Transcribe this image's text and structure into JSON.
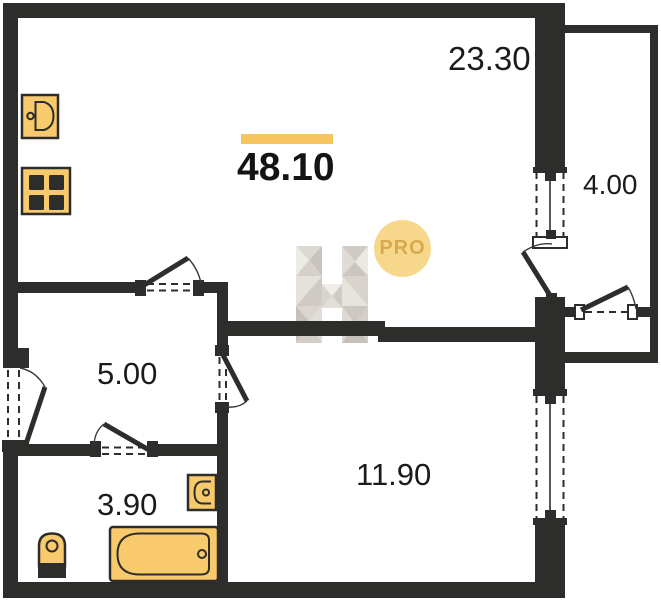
{
  "plan": {
    "total_area": "48.10",
    "badge_label": "PRO",
    "rooms": [
      {
        "name": "living-kitchen",
        "area": "23.30"
      },
      {
        "name": "loggia",
        "area": "4.00"
      },
      {
        "name": "hallway",
        "area": "5.00"
      },
      {
        "name": "bathroom",
        "area": "3.90"
      },
      {
        "name": "bedroom",
        "area": "11.90"
      }
    ],
    "fixtures": [
      "kitchen-sink",
      "stove",
      "washbasin",
      "toilet",
      "bathtub"
    ],
    "colors": {
      "wall": "#2D2D2B",
      "fixture_fill": "#F9CA6B",
      "accent_bar": "#F6C55F",
      "badge_bg": "#F7D88B",
      "badge_text": "#D9A94E",
      "label_ink": "#1B1B1B"
    }
  }
}
